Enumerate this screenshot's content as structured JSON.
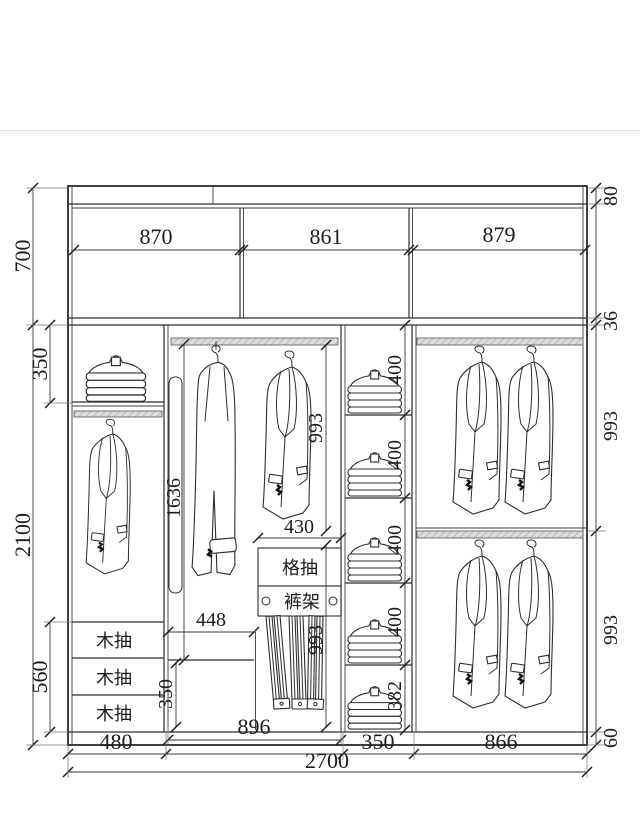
{
  "wardrobe_drawing": {
    "top_dims": {
      "left": "870",
      "middle": "861",
      "right": "879"
    },
    "left_dims": {
      "upper_cabinet_height": "700",
      "top_shelf_height": "350",
      "body_height": "2100",
      "drawer_stack_height": "560"
    },
    "right_dims": {
      "top_panel": "80",
      "shelf_thickness": "36",
      "upper_hanging": "993",
      "lower_hanging": "993",
      "base_height": "60"
    },
    "inner_dims": {
      "long_hang_height": "1636",
      "left_bay_width": "448",
      "bottom_shelf_height": "350",
      "rack_width": "430",
      "upper_hang": "993",
      "lower_hang": "993"
    },
    "shelf_stack_dims": [
      "400",
      "400",
      "400",
      "400",
      "382"
    ],
    "bottom_dims": {
      "bay1_width": "480",
      "bay2_width": "896",
      "bay3_width": "350",
      "bay4_width": "866",
      "total_width": "2700"
    },
    "labels": {
      "wood_drawer": "木抽",
      "grid_drawer": "格抽",
      "pants_rack": "裤架"
    }
  }
}
